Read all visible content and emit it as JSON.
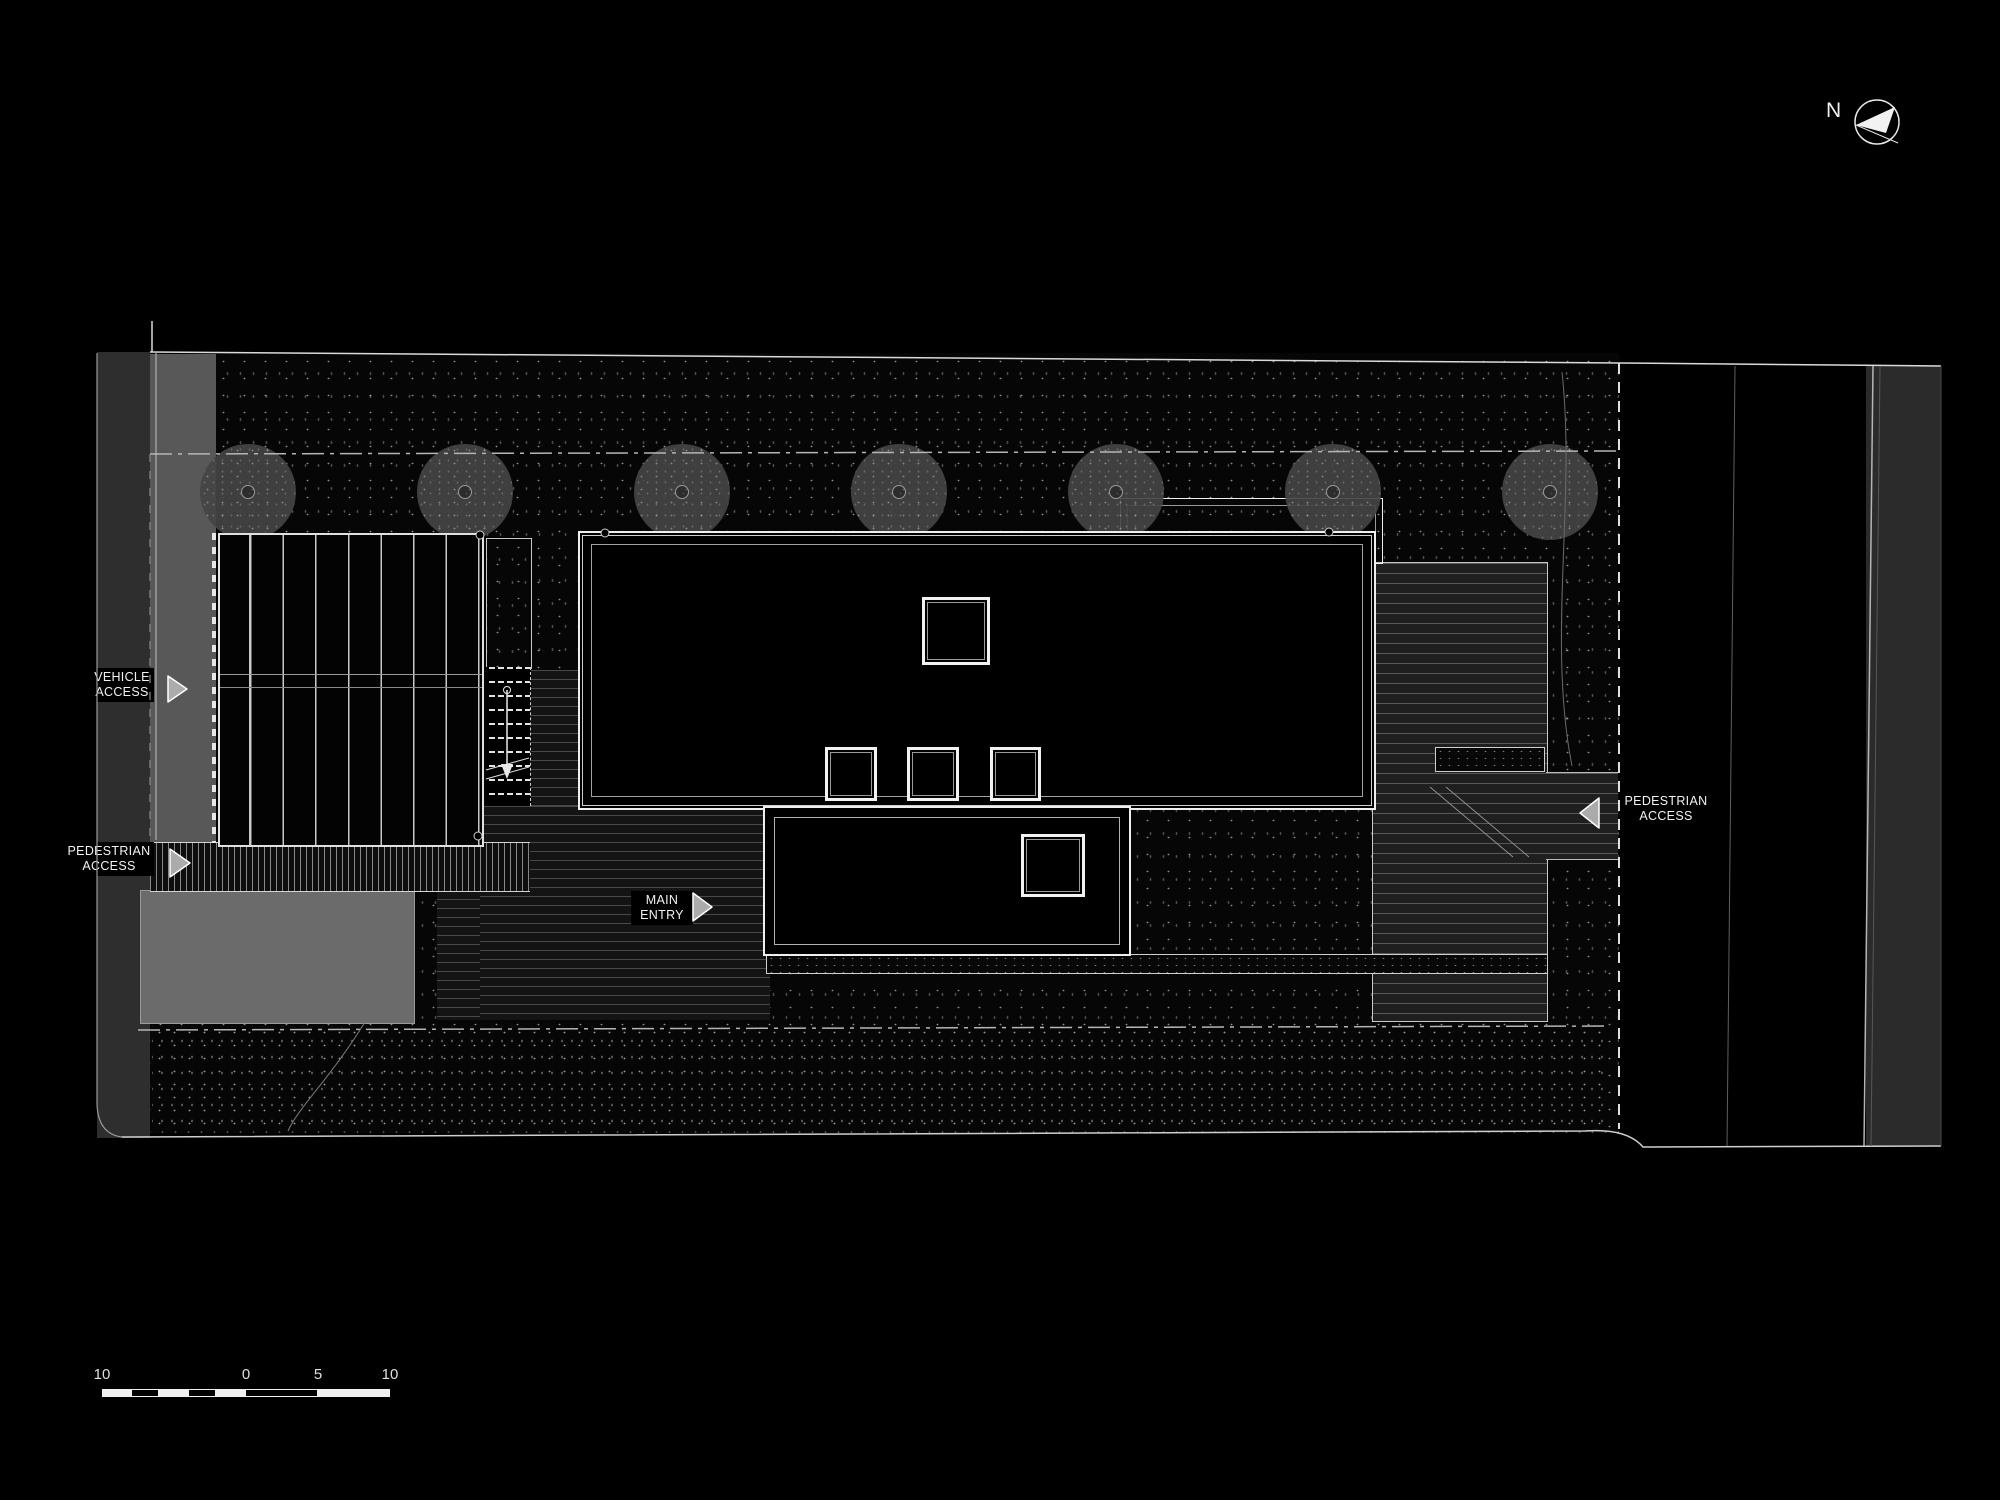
{
  "document": {
    "type": "architectural site plan, dark background with white linework",
    "orientation_note": "north arrow points left"
  },
  "north_indicator": {
    "label": "N"
  },
  "callouts": {
    "vehicle_access": {
      "line1": "VEHICLE",
      "line2": "ACCESS"
    },
    "pedestrian_access_west": {
      "line1": "PEDESTRIAN",
      "line2": "ACCESS"
    },
    "main_entry": {
      "line1": "MAIN",
      "line2": "ENTRY"
    },
    "pedestrian_access_east": {
      "line1": "PEDESTRIAN",
      "line2": "ACCESS"
    }
  },
  "scale_bar": {
    "tick_labels": [
      "10",
      "0",
      "5",
      "10"
    ]
  },
  "palette": {
    "background": "#000000",
    "linework": "#e8e8e8",
    "street": "#2e2e2e",
    "driveway": "#585858",
    "lawn_pad": "#6b6b6b",
    "deck": "#1f1f1f",
    "tree": "#464646"
  }
}
